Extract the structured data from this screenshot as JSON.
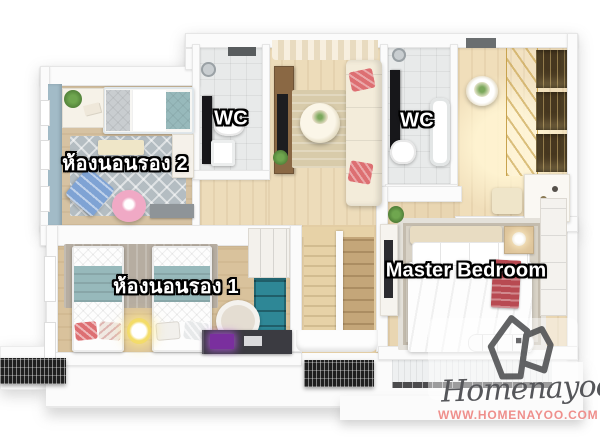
{
  "labels": {
    "bedroom2": "ห้องนอนรอง 2",
    "wc_left": "WC",
    "wc_right": "WC",
    "bedroom1": "ห้องนอนรอง 1",
    "master_bedroom": "Master Bedroom"
  },
  "branding": {
    "name": "Homenayoo",
    "website": "WWW.HOMENAYOO.COM",
    "icon": "house-outline-icon"
  },
  "palette": {
    "page_bg": "#ffffff",
    "wall": "#fbfbfb",
    "wood_hall": "#eddcba",
    "wood_closet": "#f0deba",
    "wood_bedroom2": "#d6c2a2",
    "wood_bedroom1": "#d9c29c",
    "wood_master": "#e9d6b2",
    "wood_stairhall": "#e3cda4",
    "tile": "#e8eaea",
    "accent_wall_blue": "#a2bbc7",
    "rug_bedroom2": "#b4bdc2",
    "rug_bedroom1": "#b6ada1",
    "rug_master": "#d8d2c6",
    "rug_hall": "#d8cbaa",
    "sofa_cream": "#f3ecda",
    "coral_pillow": "#dd6f72",
    "teal_blanket": "#97b9bb",
    "teal_shelf": "#2e8796",
    "pink_pouf": "#f0a9c5",
    "blue_cushion": "#7fa3d4",
    "cabinet_wood": "#8a6844",
    "stair_light": "#e7d2a7",
    "stair_dark": "#c4a679",
    "gold_trim": "#c8a34e",
    "grille_dark": "#1f1f1f",
    "label_text": "#ffffff",
    "label_outline": "#000000",
    "brand_gray": "#55565a",
    "brand_pink": "#ef8f8c"
  }
}
